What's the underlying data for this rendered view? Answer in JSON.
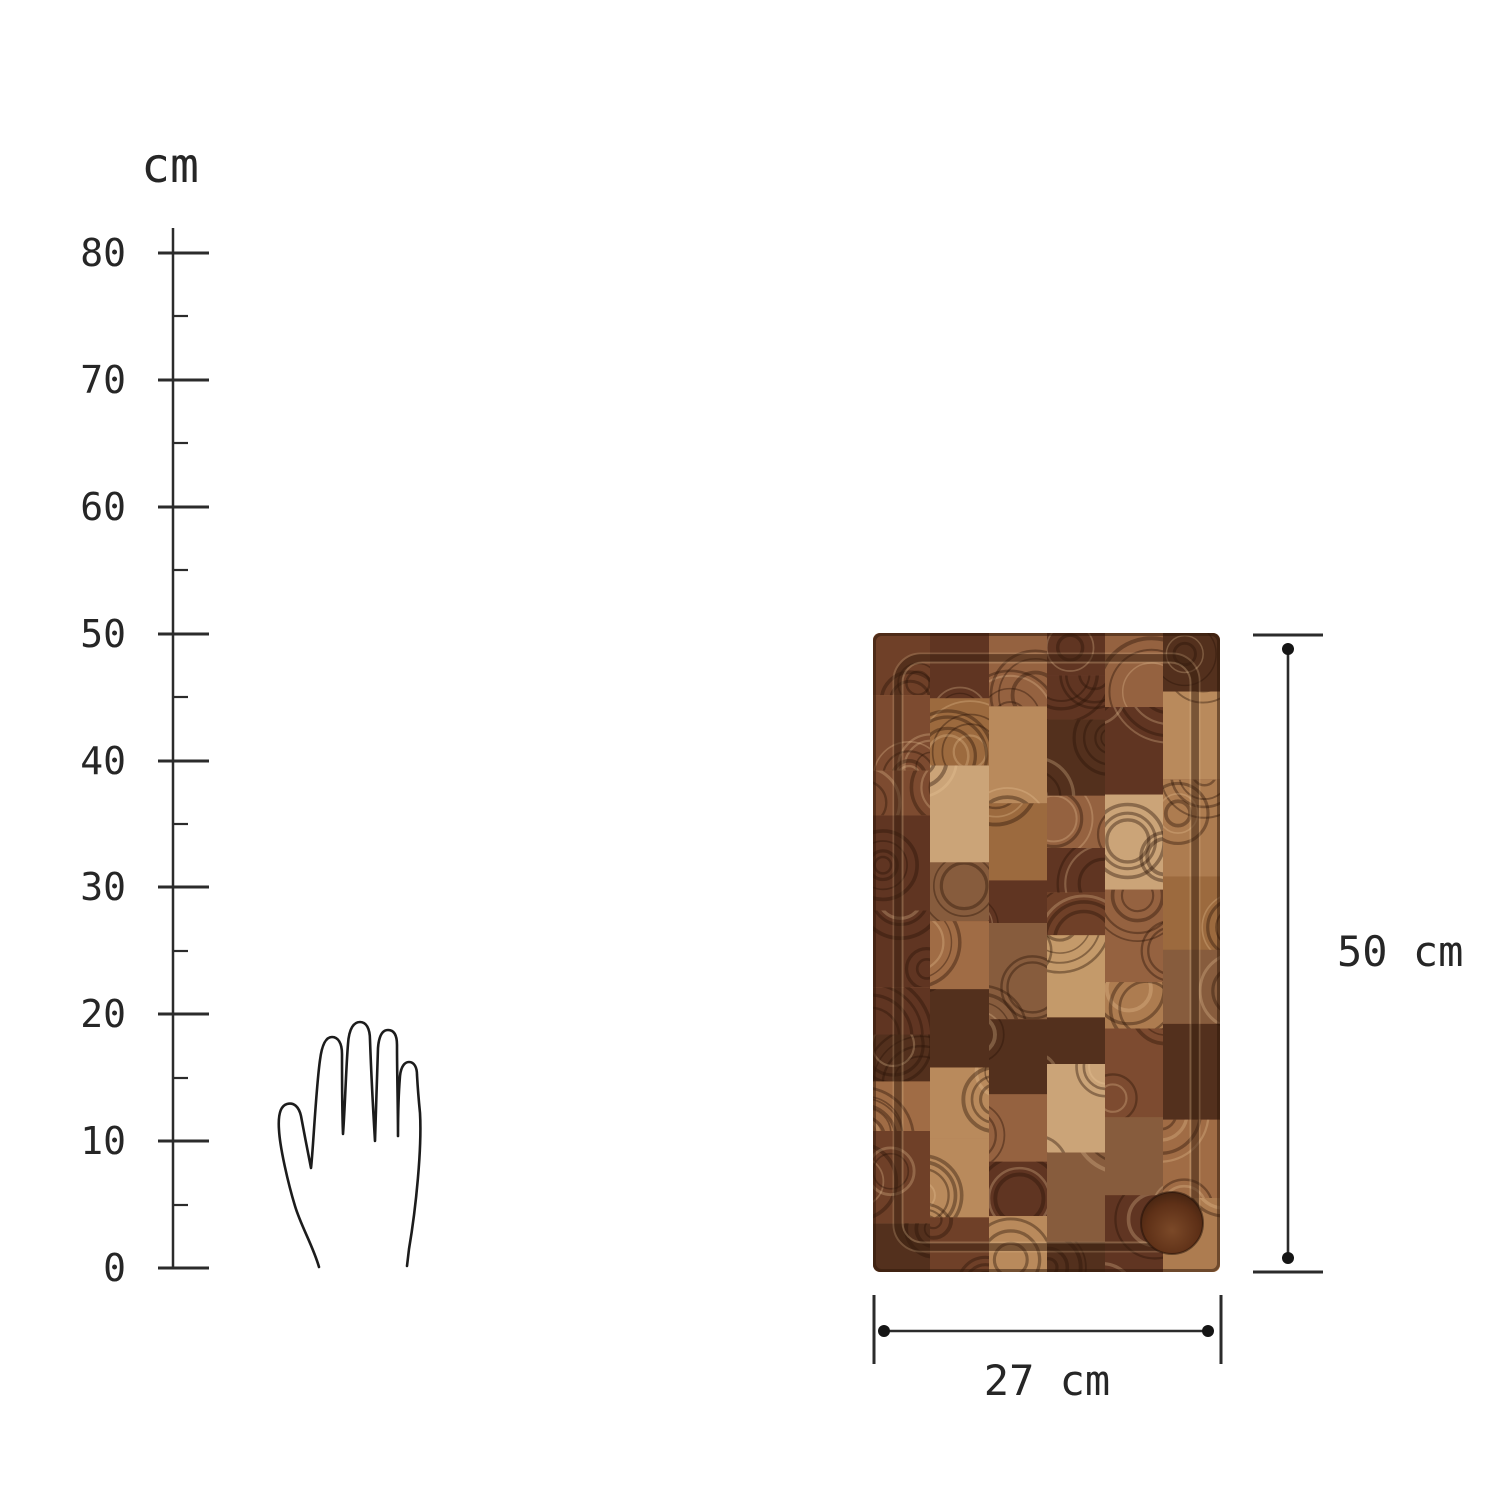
{
  "figure": {
    "background_color": "#ffffff",
    "line_color": "#2b2b2b",
    "dot_color": "#151515",
    "ruler": {
      "unit_label": "cm",
      "min": 0,
      "max": 80,
      "major_step": 10,
      "minor_step": 5,
      "major_tick_labels": [
        "0",
        "10",
        "20",
        "30",
        "40",
        "50",
        "60",
        "70",
        "80"
      ]
    },
    "hand": {
      "icon": "hand-outline-icon",
      "stroke_color": "#1c1c1c"
    },
    "board": {
      "base_color": "#8a5a3a",
      "palette": [
        "#b98a5c",
        "#ad7c50",
        "#a06c45",
        "#956240",
        "#8a5738",
        "#7d4b30",
        "#6f4028",
        "#603522",
        "#c49a6a",
        "#cba478",
        "#9c6a3e",
        "#875c3d",
        "#53301d"
      ],
      "ring_dark": "rgba(43,20,7,0.40)",
      "ring_light": "rgba(240,206,158,0.28)",
      "groove_color": "#3a2010",
      "groove_highlight_color": "#e9c99b",
      "vignette_color": "rgba(46,22,8,0.5)",
      "recess_edge_color": "#7b4928",
      "recess_mid_color": "#5e3017",
      "recess_center_color": "#3a1e0e"
    },
    "dimensions": {
      "height_label": "50 cm",
      "width_label": "27 cm"
    }
  }
}
